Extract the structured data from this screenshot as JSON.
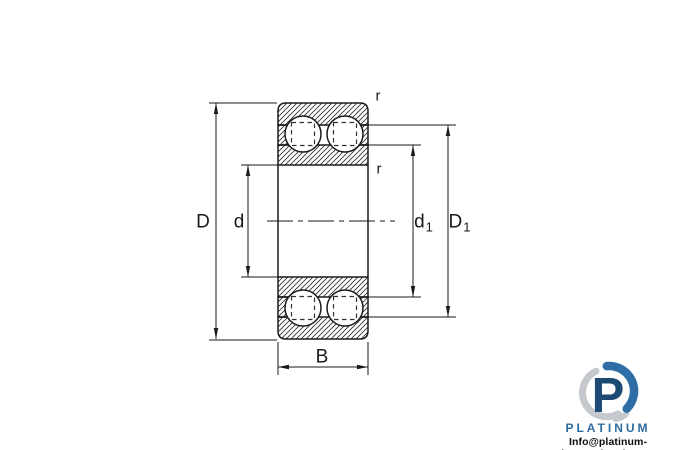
{
  "diagram": {
    "line_color": "#1a1a1a",
    "labels": {
      "outer_diameter": "D",
      "bore_diameter": "d",
      "inner_ring_shoulder": {
        "base": "d",
        "sub": "1"
      },
      "outer_ring_shoulder": {
        "base": "D",
        "sub": "1"
      },
      "width": "B",
      "chamfer_outer": "r",
      "chamfer_inner": "r"
    }
  },
  "watermark": {
    "monogram": "P",
    "brand": "PLATINUM",
    "email": "Info@platinum-international.store",
    "colors": {
      "navy": "#1d4a73",
      "blue": "#2e6da6",
      "silver": "#c5c9cd",
      "brand_text": "#2d6ba3",
      "email_text": "#0a0a0a"
    }
  }
}
